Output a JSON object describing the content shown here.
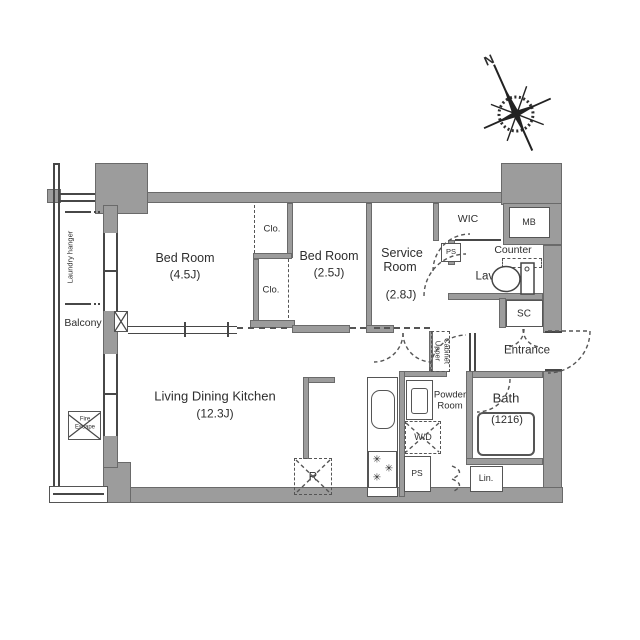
{
  "plan": {
    "compass_n": "N",
    "colors": {
      "wall": "#9c9c9c",
      "line": "#474747",
      "text": "#2e2e2e"
    },
    "balcony": {
      "label": "Balcony",
      "laundry": "Laundry hanger",
      "fire1": "Fire",
      "fire2": "Escape"
    },
    "rooms": {
      "bedroom1": {
        "name": "Bed Room",
        "size": "(4.5J)"
      },
      "bedroom2": {
        "name": "Bed Room",
        "size": "(2.5J)"
      },
      "service": {
        "line1": "Service",
        "line2": "Room",
        "size": "(2.8J)"
      },
      "ldk": {
        "name": "Living Dining Kitchen",
        "size": "(12.3J)"
      },
      "bath": {
        "name": "Bath",
        "size": "(1216)"
      },
      "powder": {
        "line1": "Powder",
        "line2": "Room"
      },
      "entrance": "Entrance",
      "lav": "Lav.",
      "wic": "WIC"
    },
    "storage": {
      "clo_upper": "Clo.",
      "clo_lower": "Clo.",
      "sc": "SC",
      "lin": "Lin.",
      "counter": "Counter",
      "upper_cabinet": {
        "line1": "Upper",
        "line2": "Cabinet"
      }
    },
    "utility": {
      "mb": "MB",
      "ps_hall": "PS",
      "ps_kitchen": "PS",
      "wd": "W/D",
      "fridge": "R"
    },
    "kitchen": {
      "burner_glyph": "✳"
    }
  }
}
